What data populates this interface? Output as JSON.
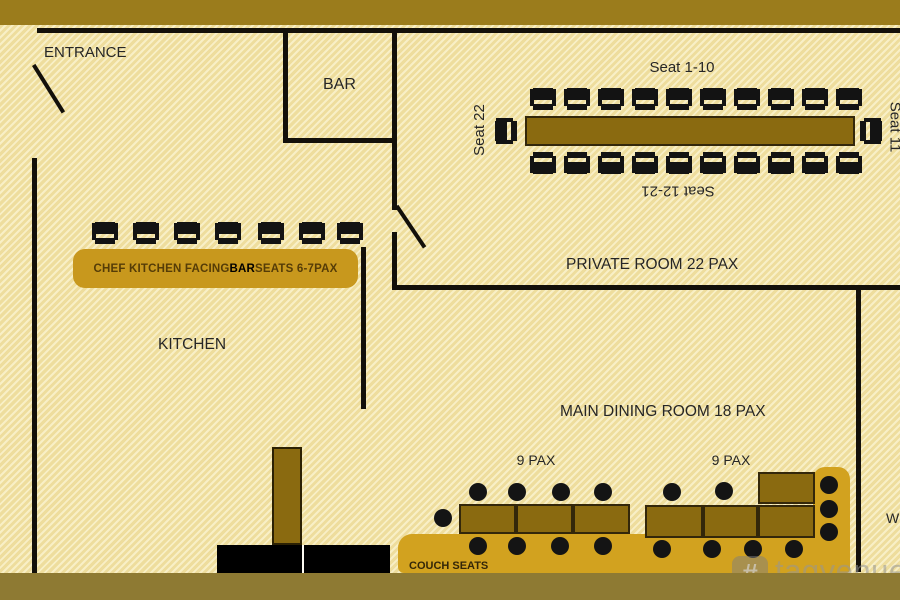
{
  "labels": {
    "entrance": "ENTRANCE",
    "bar": "BAR",
    "kitchen": "KITCHEN",
    "private_room": "PRIVATE ROOM 22 PAX",
    "seat_top": "Seat 1-10",
    "seat_bottom": "Seat 12-21",
    "seat_left": "Seat 22",
    "seat_right": "Seat 11",
    "main_dining": "MAIN DINING ROOM 18 PAX",
    "pax_left": "9 PAX",
    "pax_right": "9 PAX",
    "couch_seats": "COUCH SEATS",
    "partial_right": "W"
  },
  "chef_counter": {
    "label_parts": [
      "CHEF KITCHEN FACING ",
      "BAR",
      " SEATS 6-7PAX"
    ],
    "chair_count": 7
  },
  "watermark": {
    "logo_glyph": "#",
    "text": "tagvenue"
  },
  "colors": {
    "top_band": "#9b7c1c",
    "bottom_band": "#8e7a33",
    "floor_base": "#eedd9d",
    "floor_stripe": "#f8efc6",
    "wall": "#13100a",
    "table_fill": "#8a6a10",
    "table_border": "#33270a",
    "banner_gold": "#c8981d",
    "couch_gold": "#d2a21f",
    "dot_black": "#141414"
  },
  "floorplan": {
    "walls": [
      {
        "name": "wall-top",
        "x": 37,
        "y": 28,
        "w": 863,
        "h": 5
      },
      {
        "name": "wall-left",
        "x": 32,
        "y": 158,
        "w": 5,
        "h": 415
      },
      {
        "name": "wall-bar-left",
        "x": 283,
        "y": 28,
        "w": 5,
        "h": 112
      },
      {
        "name": "wall-bar-bottom",
        "x": 283,
        "y": 138,
        "w": 112,
        "h": 5
      },
      {
        "name": "wall-bar-right",
        "x": 392,
        "y": 28,
        "w": 5,
        "h": 182
      },
      {
        "name": "wall-private-left",
        "x": 392,
        "y": 232,
        "w": 5,
        "h": 57
      },
      {
        "name": "wall-private-bottom",
        "x": 392,
        "y": 285,
        "w": 508,
        "h": 5
      },
      {
        "name": "wall-right-interior",
        "x": 856,
        "y": 285,
        "w": 5,
        "h": 287
      },
      {
        "name": "wall-kitchen",
        "x": 361,
        "y": 247,
        "w": 5,
        "h": 162
      }
    ],
    "doors": [
      {
        "name": "entrance-door-leaf",
        "x": 32,
        "y": 66,
        "len": 56,
        "angle": -32
      },
      {
        "name": "private-room-door-leaf",
        "x": 395,
        "y": 207,
        "len": 50,
        "angle": -34
      }
    ],
    "main_table": {
      "x": 525,
      "y": 116,
      "w": 330,
      "h": 30
    },
    "chairs": [
      {
        "x": 530,
        "y": 88
      },
      {
        "x": 564,
        "y": 88
      },
      {
        "x": 598,
        "y": 88
      },
      {
        "x": 632,
        "y": 88
      },
      {
        "x": 666,
        "y": 88
      },
      {
        "x": 700,
        "y": 88
      },
      {
        "x": 734,
        "y": 88
      },
      {
        "x": 768,
        "y": 88
      },
      {
        "x": 802,
        "y": 88
      },
      {
        "x": 836,
        "y": 88
      },
      {
        "x": 530,
        "y": 150,
        "t": "flip"
      },
      {
        "x": 564,
        "y": 150,
        "t": "flip"
      },
      {
        "x": 598,
        "y": 150,
        "t": "flip"
      },
      {
        "x": 632,
        "y": 150,
        "t": "flip"
      },
      {
        "x": 666,
        "y": 150,
        "t": "flip"
      },
      {
        "x": 700,
        "y": 150,
        "t": "flip"
      },
      {
        "x": 734,
        "y": 150,
        "t": "flip"
      },
      {
        "x": 768,
        "y": 150,
        "t": "flip"
      },
      {
        "x": 802,
        "y": 150,
        "t": "flip"
      },
      {
        "x": 836,
        "y": 150,
        "t": "flip"
      },
      {
        "x": 494,
        "y": 119,
        "t": "rl"
      },
      {
        "x": 857,
        "y": 119,
        "t": "rr"
      },
      {
        "x": 92,
        "y": 222
      },
      {
        "x": 133,
        "y": 222
      },
      {
        "x": 174,
        "y": 222
      },
      {
        "x": 215,
        "y": 222
      },
      {
        "x": 258,
        "y": 222
      },
      {
        "x": 299,
        "y": 222
      },
      {
        "x": 337,
        "y": 222
      }
    ],
    "dining_tables": [
      {
        "x": 459,
        "y": 504,
        "w": 57,
        "h": 30
      },
      {
        "x": 516,
        "y": 504,
        "w": 57,
        "h": 30
      },
      {
        "x": 573,
        "y": 504,
        "w": 57,
        "h": 30
      },
      {
        "x": 645,
        "y": 505,
        "w": 58,
        "h": 33
      },
      {
        "x": 703,
        "y": 505,
        "w": 55,
        "h": 33
      },
      {
        "x": 758,
        "y": 505,
        "w": 57,
        "h": 33
      },
      {
        "x": 758,
        "y": 472,
        "w": 57,
        "h": 32
      }
    ],
    "couch": [
      {
        "x": 398,
        "y": 534,
        "w": 452,
        "h": 39,
        "r": "14px 4px 4px 6px",
        "name": "couch-horizontal"
      },
      {
        "x": 813,
        "y": 467,
        "w": 37,
        "h": 106,
        "r": "12px 12px 4px 4px",
        "name": "couch-vertical"
      }
    ],
    "dots": [
      [
        478,
        492
      ],
      [
        517,
        492
      ],
      [
        561,
        492
      ],
      [
        603,
        492
      ],
      [
        443,
        518
      ],
      [
        478,
        546
      ],
      [
        517,
        546
      ],
      [
        560,
        546
      ],
      [
        603,
        546
      ],
      [
        672,
        492
      ],
      [
        724,
        491
      ],
      [
        662,
        549
      ],
      [
        712,
        549
      ],
      [
        753,
        549
      ],
      [
        794,
        549
      ],
      [
        829,
        485
      ],
      [
        829,
        509
      ],
      [
        829,
        532
      ]
    ],
    "counters": [
      {
        "x": 217,
        "y": 545,
        "w": 85,
        "h": 28
      },
      {
        "x": 304,
        "y": 545,
        "w": 86,
        "h": 28
      }
    ]
  }
}
